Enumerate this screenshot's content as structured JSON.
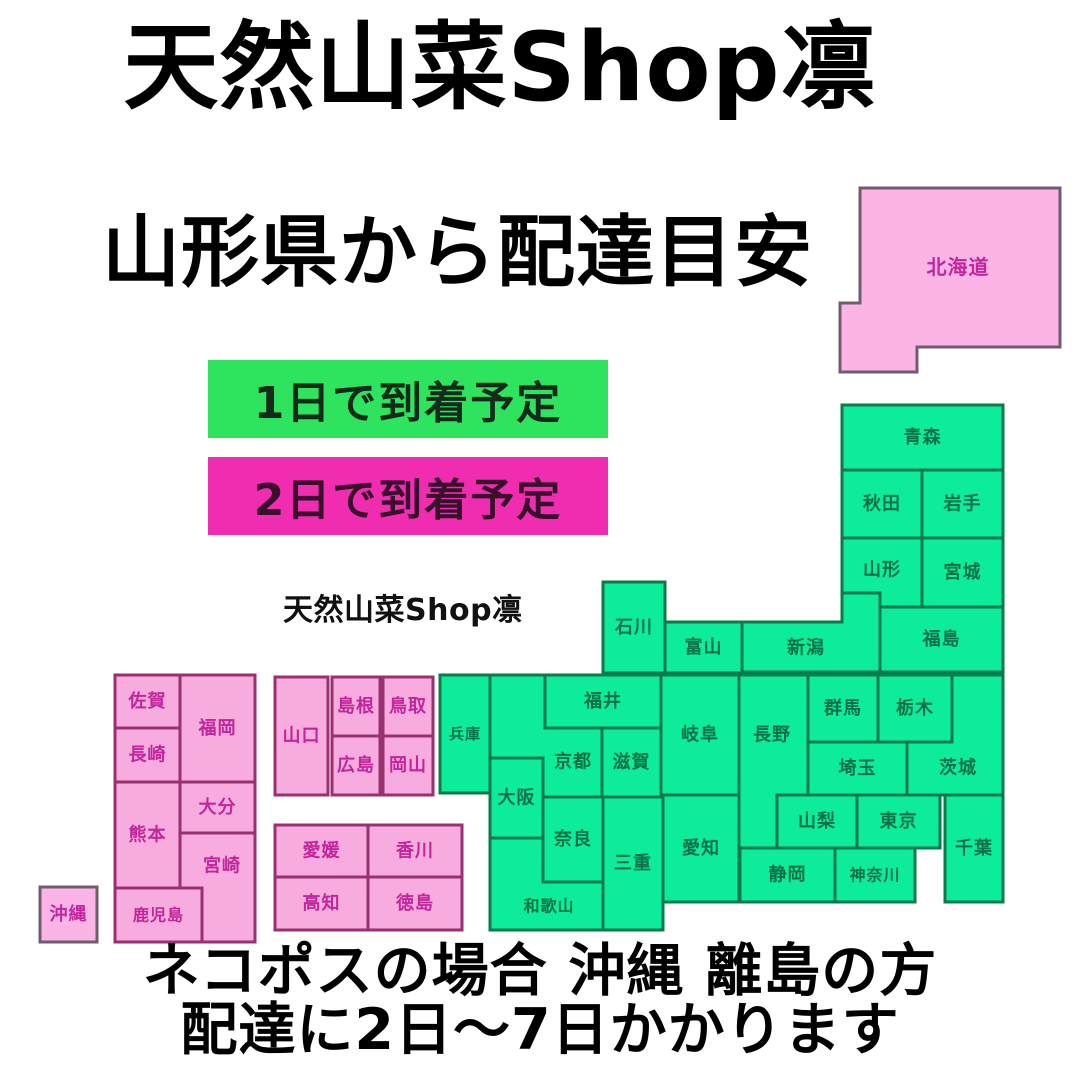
{
  "title": "天然山菜Shop凛",
  "subtitle": "山形県から配達目安",
  "watermark": "天然山菜Shop凛",
  "legend": {
    "items": [
      {
        "id": "one-day",
        "label": "1日で到着予定",
        "bg": "#2ee45f",
        "fg": "#142a1b"
      },
      {
        "id": "two-day",
        "label": "2日で到着予定",
        "bg": "#f02cb0",
        "fg": "#38102c"
      }
    ]
  },
  "footer": {
    "line1": "ネコポスの場合 沖縄 離島の方",
    "line2": "配達に2日〜7日かかります"
  },
  "map": {
    "sea_color": "#ffffff",
    "styles": {
      "one_day": {
        "fill": "#0cec9b",
        "stroke": "#0d7a4b",
        "label": "#0a7246"
      },
      "two_day": {
        "fill": "#f7abde",
        "stroke": "#993070",
        "label": "#c2269b"
      },
      "two_day_island": {
        "fill": "#fab4e6",
        "stroke": "#6f5d6e",
        "label": "#c2269b"
      }
    },
    "prefectures": [
      {
        "id": "hokkaido",
        "name": "北海道",
        "category": "two_day_island",
        "fs": 20,
        "poly": [
          [
            860,
            188
          ],
          [
            1060,
            188
          ],
          [
            1060,
            347
          ],
          [
            917,
            347
          ],
          [
            917,
            372
          ],
          [
            840,
            372
          ],
          [
            840,
            303
          ],
          [
            860,
            303
          ]
        ],
        "label": [
          958,
          267
        ]
      },
      {
        "id": "aomori",
        "name": "青森",
        "category": "one_day",
        "rect": [
          842,
          405,
          161,
          65
        ]
      },
      {
        "id": "akita",
        "name": "秋田",
        "category": "one_day",
        "rect": [
          842,
          470,
          80,
          68
        ]
      },
      {
        "id": "iwate",
        "name": "岩手",
        "category": "one_day",
        "rect": [
          922,
          470,
          81,
          68
        ]
      },
      {
        "id": "yamagata",
        "name": "山形",
        "category": "one_day",
        "poly": [
          [
            842,
            538
          ],
          [
            922,
            538
          ],
          [
            922,
            607
          ],
          [
            880,
            607
          ],
          [
            880,
            593
          ],
          [
            842,
            593
          ]
        ],
        "label": [
          882,
          570
        ]
      },
      {
        "id": "miyagi",
        "name": "宮城",
        "category": "one_day",
        "rect": [
          922,
          538,
          81,
          69
        ]
      },
      {
        "id": "fukushima",
        "name": "福島",
        "category": "one_day",
        "rect": [
          880,
          607,
          123,
          65
        ]
      },
      {
        "id": "niigata",
        "name": "新潟",
        "category": "one_day",
        "poly": [
          [
            742,
            622
          ],
          [
            842,
            622
          ],
          [
            842,
            593
          ],
          [
            880,
            593
          ],
          [
            880,
            672
          ],
          [
            742,
            672
          ]
        ],
        "label": [
          806,
          648
        ]
      },
      {
        "id": "toyama",
        "name": "富山",
        "category": "one_day",
        "rect": [
          665,
          622,
          77,
          51
        ]
      },
      {
        "id": "ishikawa",
        "name": "石川",
        "category": "one_day",
        "rect": [
          603,
          582,
          62,
          91
        ]
      },
      {
        "id": "fukui",
        "name": "福井",
        "category": "one_day",
        "rect": [
          545,
          675,
          116,
          53
        ]
      },
      {
        "id": "gifu",
        "name": "岐阜",
        "category": "one_day",
        "rect": [
          661,
          675,
          78,
          120
        ]
      },
      {
        "id": "nagano",
        "name": "長野",
        "category": "one_day",
        "poly": [
          [
            739,
            675
          ],
          [
            808,
            675
          ],
          [
            808,
            795
          ],
          [
            777,
            795
          ],
          [
            777,
            848
          ],
          [
            739,
            848
          ]
        ],
        "label": [
          772,
          735
        ]
      },
      {
        "id": "gunma",
        "name": "群馬",
        "category": "one_day",
        "rect": [
          808,
          675,
          70,
          67
        ]
      },
      {
        "id": "tochigi",
        "name": "栃木",
        "category": "one_day",
        "rect": [
          878,
          675,
          74,
          67
        ]
      },
      {
        "id": "ibaraki",
        "name": "茨城",
        "category": "one_day",
        "poly": [
          [
            952,
            675
          ],
          [
            1003,
            675
          ],
          [
            1003,
            795
          ],
          [
            907,
            795
          ],
          [
            907,
            742
          ],
          [
            952,
            742
          ]
        ],
        "label": [
          958,
          768
        ]
      },
      {
        "id": "saitama",
        "name": "埼玉",
        "category": "one_day",
        "rect": [
          808,
          742,
          99,
          53
        ]
      },
      {
        "id": "yamanashi",
        "name": "山梨",
        "category": "one_day",
        "rect": [
          777,
          795,
          80,
          53
        ]
      },
      {
        "id": "tokyo",
        "name": "東京",
        "category": "one_day",
        "rect": [
          857,
          795,
          83,
          53
        ]
      },
      {
        "id": "chiba",
        "name": "千葉",
        "category": "one_day",
        "rect": [
          945,
          795,
          58,
          107
        ]
      },
      {
        "id": "kanagawa",
        "name": "神奈川",
        "category": "one_day",
        "fs": 16,
        "rect": [
          835,
          848,
          80,
          54
        ]
      },
      {
        "id": "shizuoka",
        "name": "静岡",
        "category": "one_day",
        "rect": [
          740,
          848,
          95,
          54
        ]
      },
      {
        "id": "aichi",
        "name": "愛知",
        "category": "one_day",
        "rect": [
          663,
          795,
          76,
          107
        ]
      },
      {
        "id": "shiga",
        "name": "滋賀",
        "category": "one_day",
        "rect": [
          602,
          728,
          59,
          69
        ]
      },
      {
        "id": "kyoto",
        "name": "京都",
        "category": "one_day",
        "poly": [
          [
            490,
            675
          ],
          [
            545,
            675
          ],
          [
            545,
            728
          ],
          [
            602,
            728
          ],
          [
            602,
            797
          ],
          [
            543,
            797
          ],
          [
            543,
            758
          ],
          [
            490,
            758
          ]
        ],
        "label": [
          573,
          762
        ]
      },
      {
        "id": "hyogo",
        "name": "兵庫",
        "category": "one_day",
        "fs": 15,
        "rect": [
          440,
          675,
          50,
          118
        ]
      },
      {
        "id": "osaka",
        "name": "大阪",
        "category": "one_day",
        "rect": [
          490,
          758,
          53,
          80
        ]
      },
      {
        "id": "nara",
        "name": "奈良",
        "category": "one_day",
        "rect": [
          543,
          797,
          60,
          85
        ]
      },
      {
        "id": "wakayama",
        "name": "和歌山",
        "category": "one_day",
        "fs": 16,
        "poly": [
          [
            490,
            838
          ],
          [
            543,
            838
          ],
          [
            543,
            882
          ],
          [
            603,
            882
          ],
          [
            603,
            930
          ],
          [
            490,
            930
          ]
        ],
        "label": [
          549,
          906
        ]
      },
      {
        "id": "mie",
        "name": "三重",
        "category": "one_day",
        "rect": [
          603,
          797,
          60,
          133
        ]
      },
      {
        "id": "yamaguchi",
        "name": "山口",
        "category": "two_day",
        "rect": [
          275,
          677,
          53,
          118
        ]
      },
      {
        "id": "shimane",
        "name": "島根",
        "category": "two_day",
        "rect": [
          332,
          677,
          48,
          59
        ]
      },
      {
        "id": "tottori",
        "name": "鳥取",
        "category": "two_day",
        "rect": [
          383,
          677,
          50,
          59
        ]
      },
      {
        "id": "hiroshima",
        "name": "広島",
        "category": "two_day",
        "rect": [
          332,
          736,
          48,
          59
        ]
      },
      {
        "id": "okayama",
        "name": "岡山",
        "category": "two_day",
        "rect": [
          383,
          736,
          50,
          59
        ]
      },
      {
        "id": "ehime",
        "name": "愛媛",
        "category": "two_day",
        "rect": [
          275,
          825,
          93,
          52
        ]
      },
      {
        "id": "kagawa",
        "name": "香川",
        "category": "two_day",
        "rect": [
          368,
          825,
          94,
          52
        ]
      },
      {
        "id": "kochi",
        "name": "高知",
        "category": "two_day",
        "rect": [
          275,
          877,
          93,
          53
        ]
      },
      {
        "id": "tokushima",
        "name": "徳島",
        "category": "two_day",
        "rect": [
          368,
          877,
          94,
          53
        ]
      },
      {
        "id": "saga",
        "name": "佐賀",
        "category": "two_day",
        "rect": [
          115,
          675,
          65,
          53
        ]
      },
      {
        "id": "fukuoka",
        "name": "福岡",
        "category": "two_day",
        "rect": [
          180,
          675,
          75,
          107
        ]
      },
      {
        "id": "nagasaki",
        "name": "長崎",
        "category": "two_day",
        "rect": [
          115,
          728,
          65,
          54
        ]
      },
      {
        "id": "kumamoto",
        "name": "熊本",
        "category": "two_day",
        "rect": [
          115,
          782,
          65,
          106
        ]
      },
      {
        "id": "oita",
        "name": "大分",
        "category": "two_day",
        "rect": [
          180,
          782,
          75,
          51
        ]
      },
      {
        "id": "miyazaki",
        "name": "宮崎",
        "category": "two_day",
        "poly": [
          [
            180,
            833
          ],
          [
            255,
            833
          ],
          [
            255,
            942
          ],
          [
            202,
            942
          ],
          [
            202,
            888
          ],
          [
            180,
            888
          ]
        ],
        "label": [
          222,
          866
        ]
      },
      {
        "id": "kagoshima",
        "name": "鹿児島",
        "category": "two_day",
        "fs": 16,
        "rect": [
          115,
          888,
          87,
          54
        ]
      },
      {
        "id": "okinawa",
        "name": "沖縄",
        "category": "two_day_island",
        "rect": [
          40,
          887,
          57,
          55
        ]
      }
    ]
  }
}
